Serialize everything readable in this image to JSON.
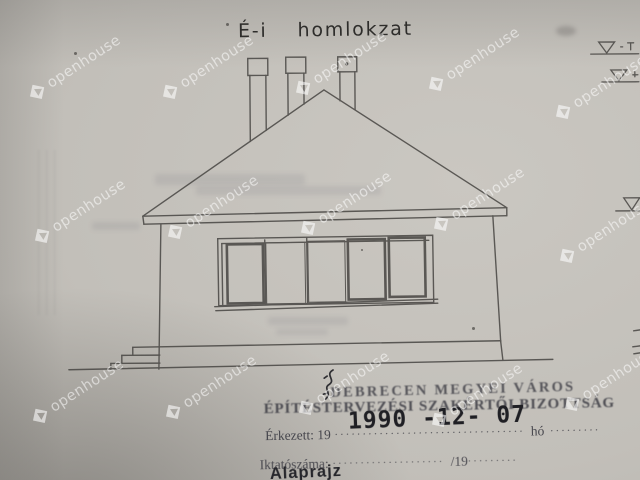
{
  "title": {
    "prefix": "É-i",
    "word": "homlokzat"
  },
  "watermark": {
    "text": "openhouse",
    "logo_icon": "diamond-c-logo",
    "positions": [
      {
        "x": 30,
        "y": 88
      },
      {
        "x": 163,
        "y": 88
      },
      {
        "x": 296,
        "y": 84
      },
      {
        "x": 429,
        "y": 80
      },
      {
        "x": 556,
        "y": 108
      },
      {
        "x": 35,
        "y": 232
      },
      {
        "x": 168,
        "y": 228
      },
      {
        "x": 301,
        "y": 224
      },
      {
        "x": 434,
        "y": 220
      },
      {
        "x": 560,
        "y": 252
      },
      {
        "x": 33,
        "y": 412
      },
      {
        "x": 166,
        "y": 408
      },
      {
        "x": 299,
        "y": 404
      },
      {
        "x": 432,
        "y": 416
      },
      {
        "x": 565,
        "y": 400
      }
    ]
  },
  "drawing": {
    "level_marker_icon": "inverted-triangle-level-marker",
    "level_marker_count": 3,
    "chimney_count": 3,
    "window_pane_count": 5
  },
  "stamp": {
    "org_line1": "DEBRECEN MEGYEI VÁROS",
    "org_line2": "ÉPÍTÉSTERVEZÉSI SZAKÉRTŐI BIZOTTSÁG",
    "received_label": "Érkezett: 19",
    "received_dots": "..................................",
    "date_stamp": "1990 -12- 07",
    "month_label": "hó",
    "month_dots": ".........",
    "file_label": "Iktatószáma:",
    "file_dots": "....................",
    "file_suffix": "/19",
    "file_suffix_dots": ".........",
    "doc_type": "Alaprajz"
  },
  "colors": {
    "paper": "#c2bfb9",
    "line_ink": "#4b4946",
    "stamp_ink": "#3a3a42",
    "date_ink": "#1f1f24",
    "watermark": "#ffffff"
  }
}
